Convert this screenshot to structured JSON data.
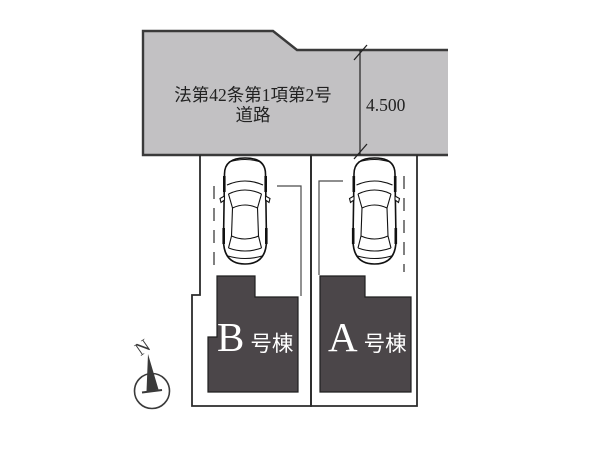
{
  "plan": {
    "road": {
      "label_line1": "法第42条第1項第2号",
      "label_line2": "道路",
      "dimension": "4.500"
    },
    "buildings": [
      {
        "id": "B",
        "letter": "B",
        "suffix": "号棟"
      },
      {
        "id": "A",
        "letter": "A",
        "suffix": "号棟"
      }
    ],
    "compass": {
      "north_label": "N"
    }
  },
  "colors": {
    "road_fill": "#c2c1c3",
    "road_stroke": "#3a3a3a",
    "parcel_stroke": "#2b2b2b",
    "building_fill": "#4b4649",
    "building_stroke": "#1f1f1f",
    "building_label_text": "#ffffff",
    "road_text": "#222222",
    "dimension_text": "#222222",
    "thin_line": "#4a4a4a",
    "compass_color": "#3a3a3a",
    "car_line": "#111111"
  }
}
